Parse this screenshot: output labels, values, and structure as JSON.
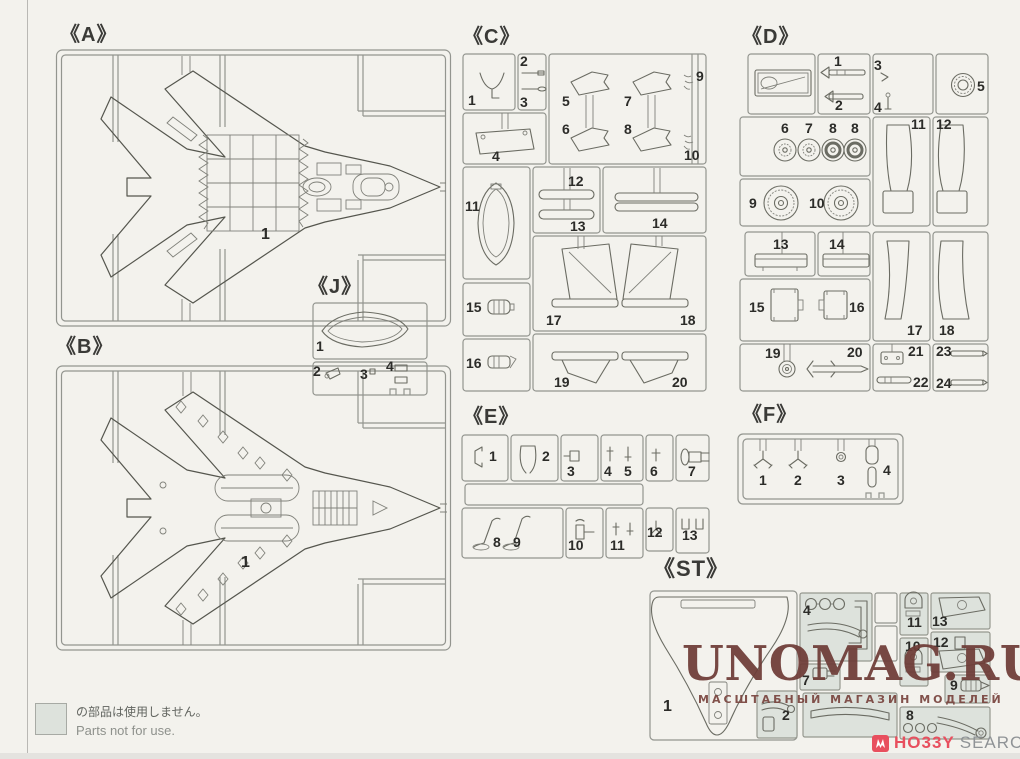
{
  "page": {
    "background": "#f3f2ed",
    "runner_line_color": "#93958f",
    "part_line_color": "#5b5c54",
    "not_for_use_fill": "#dde2dc"
  },
  "sections": {
    "A": {
      "label": "《A》",
      "parts": [
        "1"
      ]
    },
    "B": {
      "label": "《B》",
      "parts": [
        "1"
      ]
    },
    "J": {
      "label": "《J》",
      "parts": [
        "1",
        "2",
        "3",
        "4"
      ]
    },
    "C": {
      "label": "《C》",
      "parts": [
        "1",
        "2",
        "3",
        "4",
        "5",
        "6",
        "7",
        "8",
        "9",
        "10",
        "11",
        "12",
        "13",
        "14",
        "15",
        "16",
        "17",
        "18",
        "19",
        "20"
      ]
    },
    "D": {
      "label": "《D》",
      "parts": [
        "1",
        "2",
        "3",
        "4",
        "5",
        "6",
        "7",
        "8",
        "8",
        "9",
        "10",
        "11",
        "12",
        "13",
        "14",
        "15",
        "16",
        "17",
        "18",
        "19",
        "20",
        "21",
        "22",
        "23",
        "24"
      ]
    },
    "E": {
      "label": "《E》",
      "parts": [
        "1",
        "2",
        "3",
        "4",
        "5",
        "6",
        "7",
        "8",
        "9",
        "10",
        "11",
        "12",
        "13"
      ]
    },
    "F": {
      "label": "《F》",
      "parts": [
        "1",
        "2",
        "3",
        "4"
      ]
    },
    "ST": {
      "label": "《ST》",
      "parts": [
        "1",
        "2",
        "4",
        "7",
        "8",
        "9",
        "10",
        "11",
        "12",
        "13"
      ]
    }
  },
  "legend": {
    "jp": "の部品は使用しません。",
    "en": "Parts not for use."
  },
  "watermark": {
    "title": "UNOMAG.RU",
    "subtitle": "МАСШТАБНЫЙ МАГАЗИН МОДЕЛЕЙ",
    "color": "#6e3c37"
  },
  "logo": {
    "brand_red": "HO33Y",
    "brand_gray": "SEARCH",
    "color": "#e84f5e"
  }
}
